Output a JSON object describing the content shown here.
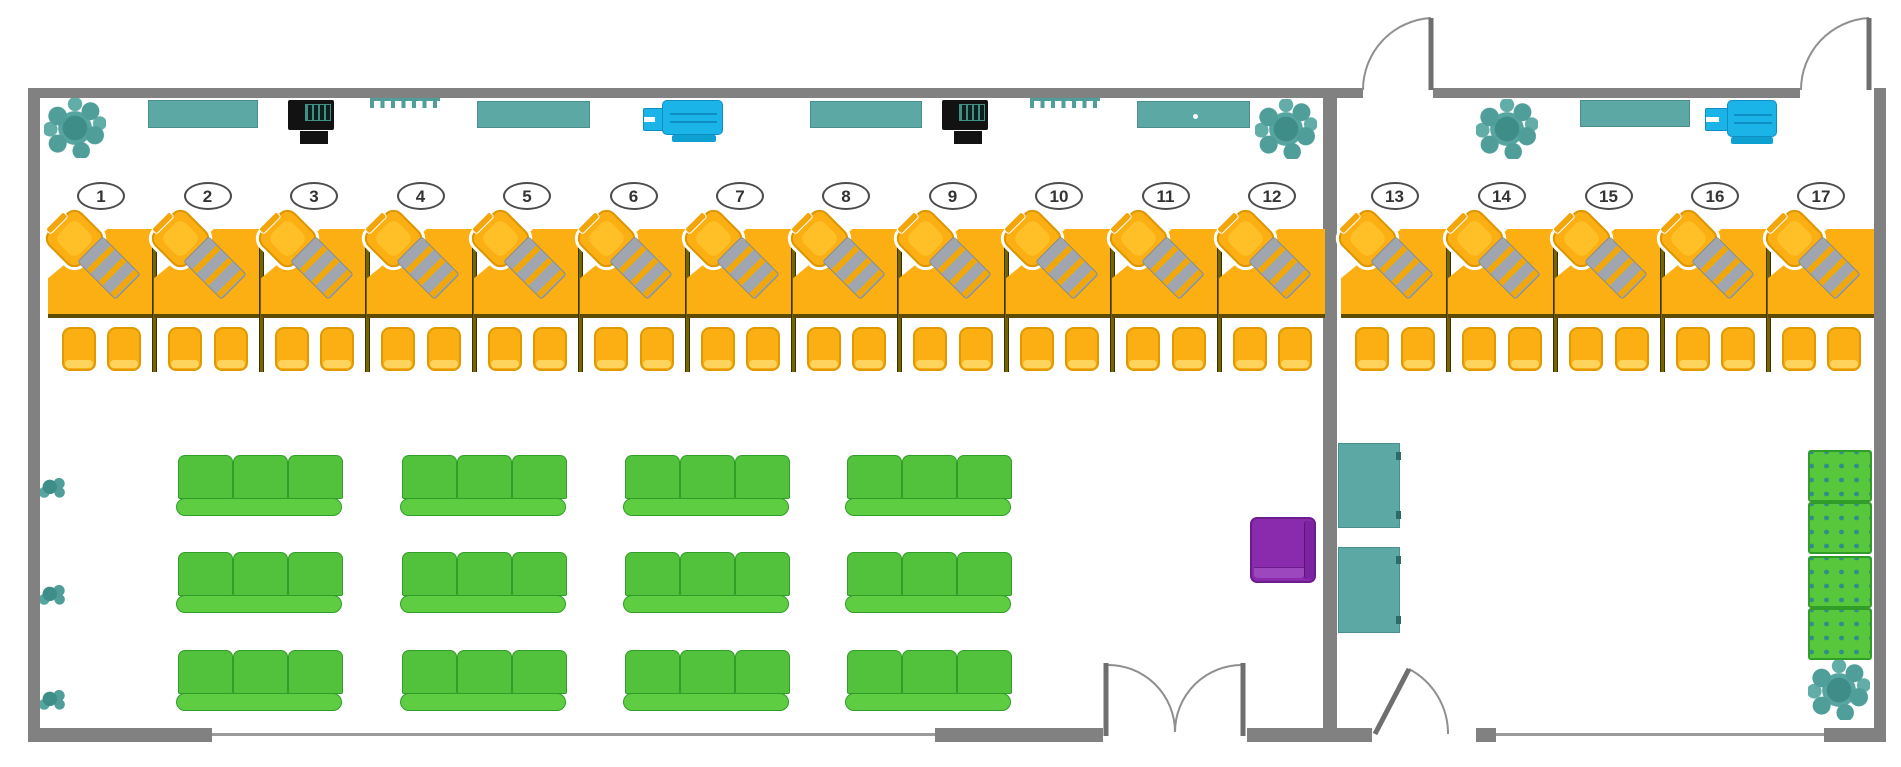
{
  "title": "Office floor plan with numbered teller workstations and waiting area",
  "colors": {
    "wall": "#818181",
    "desk_orange": "#FBAF12",
    "chair_orange": "#FBAF12",
    "sofa_green": "#52C23C",
    "ottoman_green": "#58C73C",
    "teal": "#5BA8A4",
    "cyan_device": "#1AB4E8",
    "purple_chair": "#8A2BAD",
    "plant_teal": "#4F9E99",
    "divider_olive": "#756400",
    "window_gray": "#9b9b9b"
  },
  "stations": [
    {
      "label": "1",
      "x": 48,
      "w": 106,
      "divider": true
    },
    {
      "label": "2",
      "x": 154,
      "w": 107,
      "divider": true
    },
    {
      "label": "3",
      "x": 261,
      "w": 106,
      "divider": true
    },
    {
      "label": "4",
      "x": 367,
      "w": 107,
      "divider": true
    },
    {
      "label": "5",
      "x": 474,
      "w": 106,
      "divider": true
    },
    {
      "label": "6",
      "x": 580,
      "w": 107,
      "divider": true
    },
    {
      "label": "7",
      "x": 687,
      "w": 106,
      "divider": true
    },
    {
      "label": "8",
      "x": 793,
      "w": 106,
      "divider": true
    },
    {
      "label": "9",
      "x": 899,
      "w": 107,
      "divider": true
    },
    {
      "label": "10",
      "x": 1006,
      "w": 106,
      "divider": true
    },
    {
      "label": "11",
      "x": 1112,
      "w": 107,
      "divider": true
    },
    {
      "label": "12",
      "x": 1219,
      "w": 106,
      "divider": false
    },
    {
      "label": "13",
      "x": 1341,
      "w": 107,
      "divider": true
    },
    {
      "label": "14",
      "x": 1448,
      "w": 107,
      "divider": true
    },
    {
      "label": "15",
      "x": 1555,
      "w": 107,
      "divider": true
    },
    {
      "label": "16",
      "x": 1662,
      "w": 106,
      "divider": true
    },
    {
      "label": "17",
      "x": 1768,
      "w": 106,
      "divider": false
    }
  ],
  "station_metrics": {
    "badge_y": 182,
    "desk_y": 229,
    "desk_h": 85,
    "line_y": 314,
    "chair_y": 327,
    "divider_y": 229,
    "divider_h": 143
  },
  "walls": [
    {
      "name": "wall-left",
      "x": 28,
      "y": 88,
      "w": 12,
      "h": 654
    },
    {
      "name": "wall-top-left-room",
      "x": 28,
      "y": 88,
      "w": 1335,
      "h": 10
    },
    {
      "name": "wall-top-right-room",
      "x": 1433,
      "y": 88,
      "w": 367,
      "h": 10
    },
    {
      "name": "wall-right",
      "x": 1874,
      "y": 88,
      "w": 12,
      "h": 654
    },
    {
      "name": "wall-divider-rooms",
      "x": 1323,
      "y": 88,
      "w": 14,
      "h": 654
    },
    {
      "name": "wall-bottom-1",
      "x": 28,
      "y": 728,
      "w": 184,
      "h": 14
    },
    {
      "name": "wall-bottom-2",
      "x": 935,
      "y": 728,
      "w": 168,
      "h": 14
    },
    {
      "name": "wall-bottom-3",
      "x": 1247,
      "y": 728,
      "w": 125,
      "h": 14
    },
    {
      "name": "wall-bottom-4",
      "x": 1476,
      "y": 728,
      "w": 20,
      "h": 14
    },
    {
      "name": "wall-bottom-5",
      "x": 1824,
      "y": 728,
      "w": 62,
      "h": 14
    }
  ],
  "windows": [
    {
      "name": "window-bottom-left",
      "x": 212,
      "y": 733,
      "w": 723,
      "h": 3
    },
    {
      "name": "window-bottom-right",
      "x": 1496,
      "y": 733,
      "w": 328,
      "h": 3
    }
  ],
  "doors": {
    "leaves": [
      {
        "name": "door-leaf-top-1",
        "x1": 1431,
        "y1": 18,
        "x2": 1431,
        "y2": 90
      },
      {
        "name": "door-leaf-top-2",
        "x1": 1869,
        "y1": 18,
        "x2": 1869,
        "y2": 90
      },
      {
        "name": "door-leaf-bottom-right",
        "x1": 1375,
        "y1": 734,
        "x2": 1409,
        "y2": 669
      },
      {
        "name": "double-door-leaf-left",
        "x1": 1106,
        "y1": 663,
        "x2": 1106,
        "y2": 736
      },
      {
        "name": "double-door-leaf-right",
        "x1": 1243,
        "y1": 663,
        "x2": 1243,
        "y2": 736
      }
    ],
    "arcs": [
      {
        "name": "door-arc-top-1",
        "d": "M1431,18 A72,72 0 0 0 1363,90"
      },
      {
        "name": "door-arc-top-2",
        "d": "M1869,18 A72,72 0 0 0 1801,90"
      },
      {
        "name": "door-arc-bottom-right",
        "d": "M1409,669 A73,73 0 0 1 1448,734"
      },
      {
        "name": "double-door-arc-left",
        "d": "M1106,665 A67,67 0 0 1 1175,732"
      },
      {
        "name": "double-door-arc-right",
        "d": "M1243,665 A67,67 0 0 0 1175,732"
      }
    ]
  },
  "sofas": {
    "cols": [
      176,
      400,
      623,
      845
    ],
    "rows": [
      455,
      552,
      650
    ],
    "w": 168,
    "h": 62,
    "seats_per_sofa": 3
  },
  "ottomans": [
    {
      "x": 1808,
      "y": 450
    },
    {
      "x": 1808,
      "y": 502
    },
    {
      "x": 1808,
      "y": 556
    },
    {
      "x": 1808,
      "y": 608
    }
  ],
  "purple_armchair": {
    "x": 1250,
    "y": 517
  },
  "wall_cabinets": [
    {
      "name": "cabinet-top-1",
      "x": 148,
      "y": 100,
      "w": 110,
      "h": 28
    },
    {
      "name": "cabinet-top-2",
      "x": 477,
      "y": 101,
      "w": 113,
      "h": 27
    },
    {
      "name": "cabinet-top-3",
      "x": 810,
      "y": 101,
      "w": 112,
      "h": 27
    },
    {
      "name": "cabinet-top-4",
      "x": 1137,
      "y": 101,
      "w": 113,
      "h": 27,
      "handle": true
    },
    {
      "name": "cabinet-top-5",
      "x": 1580,
      "y": 100,
      "w": 110,
      "h": 27
    }
  ],
  "side_cabinets": [
    {
      "name": "cabinet-side-1",
      "x": 1338,
      "y": 443,
      "w": 62,
      "h": 85
    },
    {
      "name": "cabinet-side-2",
      "x": 1338,
      "y": 547,
      "w": 62,
      "h": 86
    }
  ],
  "printers": [
    {
      "name": "printer-1",
      "x": 288,
      "y": 100
    },
    {
      "name": "printer-2",
      "x": 942,
      "y": 100
    }
  ],
  "wall_racks": [
    {
      "name": "wall-rack-1",
      "x": 370,
      "y": 98,
      "w": 70
    },
    {
      "name": "wall-rack-2",
      "x": 1030,
      "y": 98,
      "w": 70
    }
  ],
  "cyan_devices": [
    {
      "name": "cyan-device-1",
      "bx": 662,
      "by": 100,
      "bw": 61,
      "bh": 35,
      "nx": 643,
      "ny": 108,
      "nw": 21,
      "nh": 23,
      "tx": 672,
      "ty": 135,
      "tw": 44,
      "th": 7
    },
    {
      "name": "cyan-device-2",
      "bx": 1727,
      "by": 100,
      "bw": 50,
      "bh": 37,
      "nx": 1705,
      "ny": 108,
      "nw": 24,
      "nh": 23,
      "tx": 1731,
      "ty": 137,
      "tw": 42,
      "th": 7
    }
  ],
  "plants_large": [
    {
      "name": "plant-top-left",
      "x": 44,
      "y": 98
    },
    {
      "name": "plant-left-room-right",
      "x": 1255,
      "y": 99
    },
    {
      "name": "plant-right-room-top",
      "x": 1476,
      "y": 99
    },
    {
      "name": "plant-bottom-right",
      "x": 1808,
      "y": 660
    }
  ],
  "plants_small": [
    {
      "name": "plant-small-1",
      "x": 40,
      "y": 477
    },
    {
      "name": "plant-small-2",
      "x": 40,
      "y": 584
    },
    {
      "name": "plant-small-3",
      "x": 40,
      "y": 689
    }
  ]
}
